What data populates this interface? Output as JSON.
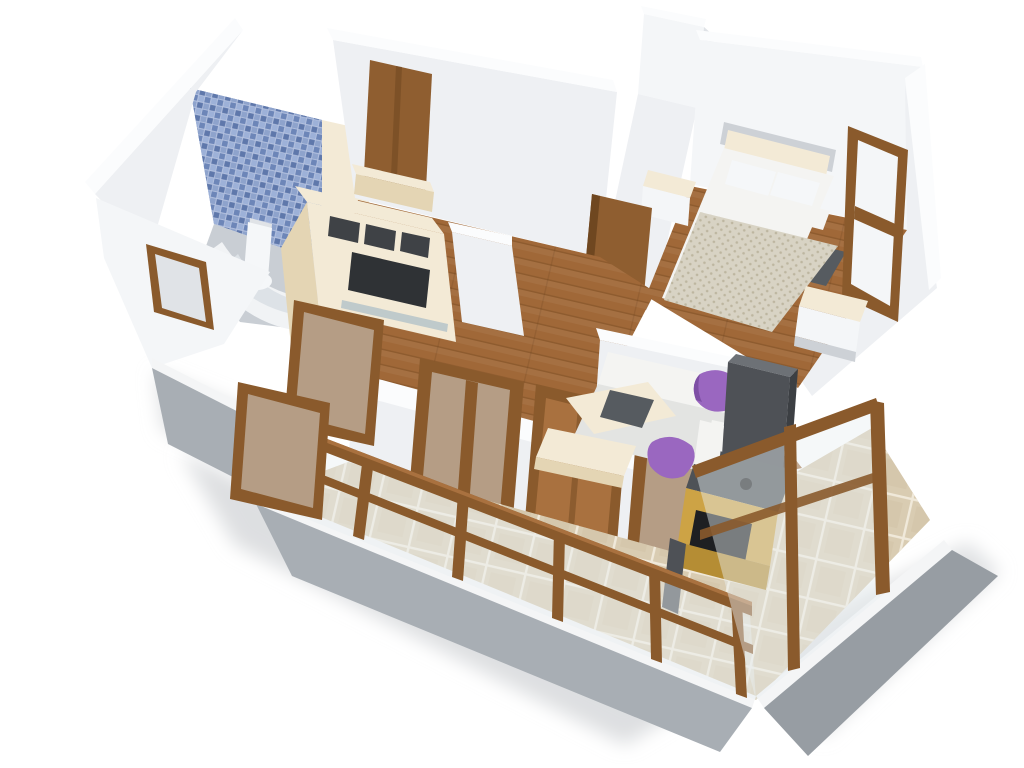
{
  "scene": {
    "type": "3d-apartment-floor-plan-render",
    "view": "aerial-dollhouse-cutaway",
    "background": "#ffffff",
    "rooms": {
      "bathroom": {
        "name": "bathroom",
        "features": [
          "blue-mosaic-tile-wall",
          "corner-bathtub",
          "toilet",
          "exterior-window",
          "grey-floor"
        ]
      },
      "hallway": {
        "name": "hallway",
        "features": [
          "wooden-entry-door",
          "wood-floor",
          "overhead-cream-beam"
        ]
      },
      "bedroom": {
        "name": "bedroom",
        "features": [
          "double-bed",
          "cream-headboard",
          "four-white-pillows",
          "knit-blanket",
          "nightstand-left",
          "nightstand-right",
          "dark-rug",
          "wood-window",
          "open-wooden-door",
          "wood-floor"
        ]
      },
      "living_room": {
        "name": "living-room",
        "features": [
          "cream-tv-wall-unit",
          "white-corner-sofa",
          "two-purple-cushions",
          "nesting-coffee-tables",
          "wood-floor",
          "glazed-sliding-doors-to-balcony"
        ]
      },
      "kitchen": {
        "name": "kitchen-niche",
        "features": [
          "tall-dark-fridge",
          "gold-cabinets",
          "dark-counter-with-sink",
          "open-black-compartment"
        ]
      },
      "balcony": {
        "name": "wrap-around-balcony",
        "features": [
          "wood-and-glass-railing",
          "corner-frame-towers",
          "beige-marble-tile-floor",
          "white-slab-edge",
          "grey-concrete-base"
        ]
      }
    }
  },
  "palette": {
    "bg": "#ffffff",
    "shadow": "#d7d9dc",
    "wallTop": "#fbfcfd",
    "wall": "#eef0f3",
    "wallLt": "#f4f6f8",
    "wallSh": "#e0e3e7",
    "wallDk": "#cdd1d6",
    "blueTile": "#8ea3cc",
    "blueTileDk": "#5f78ab",
    "blueTileMd": "#6d86b8",
    "blueTileLt": "#9db1d8",
    "blueGrout": "#b6c3e0",
    "bathFloor": "#c9ced4",
    "tub": "#f1f3f5",
    "tubShade": "#dde2e7",
    "porcelain": "#f5f7f9",
    "woodFrame": "#8a5a2c",
    "woodFrameDk": "#6f4720",
    "woodFrameLt": "#a9713f",
    "doorWood": "#8f5e30",
    "floorWood": "#a06838",
    "plankLine": "#5e3a16",
    "cream": "#f3ead6",
    "creamDk": "#e4d5b4",
    "slotDark": "#3f4246",
    "tvDark": "#2f3235",
    "glassShelf": "#aebfc7",
    "sofa": "#f4f4f2",
    "sofaShade": "#e3e4e2",
    "purple": "#9a67c0",
    "purpleDk": "#7e4fa5",
    "blanket": "#d8d3c4",
    "blanketDot": "#bdb6a0",
    "rug": "#565b60",
    "gold": "#cda345",
    "goldDk": "#b58d34",
    "counterDark": "#4e5257",
    "fridge": "#4e5156",
    "fridgeTop": "#6d7176",
    "fridgeSide": "#3c3f43",
    "sinkBlack": "#1e1f22",
    "tileBeige": "#d9ccb2",
    "tileBeigeDk": "#cfc0a2",
    "tileGrout": "#f0e9da",
    "concrete": "#a8aeb4",
    "concreteDk": "#979da3",
    "slab": "#f4f5f6",
    "glass": "#e9eff2"
  }
}
